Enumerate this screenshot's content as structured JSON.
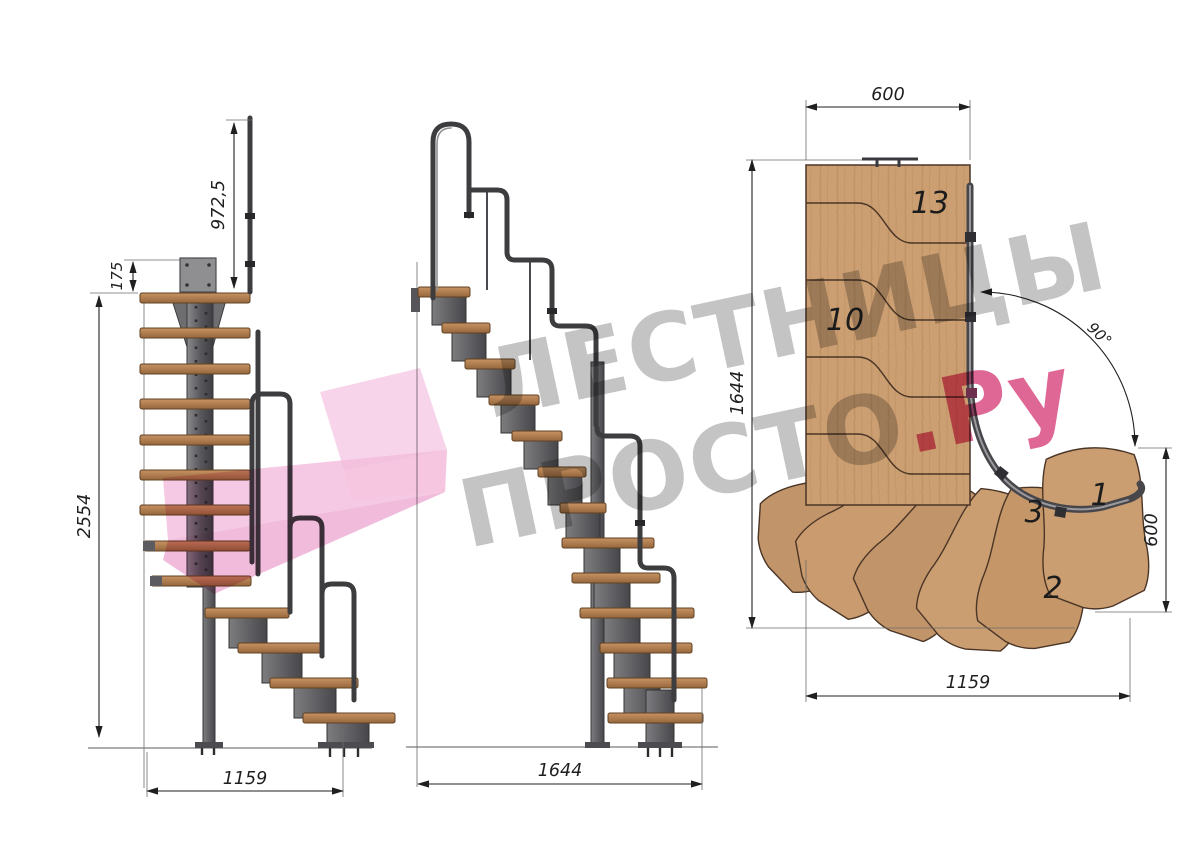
{
  "side_view": {
    "dims": {
      "rail_height": "972,5",
      "plate_offset": "175",
      "total_height": "2554",
      "run": "1159"
    }
  },
  "front_view": {
    "dims": {
      "run": "1644"
    }
  },
  "plan_view": {
    "dims": {
      "top_width": "600",
      "length": "1644",
      "turn_angle": "90°",
      "right_width": "600",
      "bottom_width": "1159"
    },
    "steps": {
      "n13": "13",
      "n10": "10",
      "n3": "3",
      "n1": "1",
      "n2": "2"
    }
  },
  "watermark": {
    "line1": "ЛЕСТНИЦЫ",
    "line2": "ПРОСТО",
    "suffix": ".Ру"
  },
  "colors": {
    "wood_side": "#b5824f",
    "wood_plan": "#cb9f72",
    "metal": "#55555a",
    "watermark_gray": "#a0a0a0",
    "watermark_pink": "#d63c77",
    "arrow_pink": "#f3bedd"
  }
}
